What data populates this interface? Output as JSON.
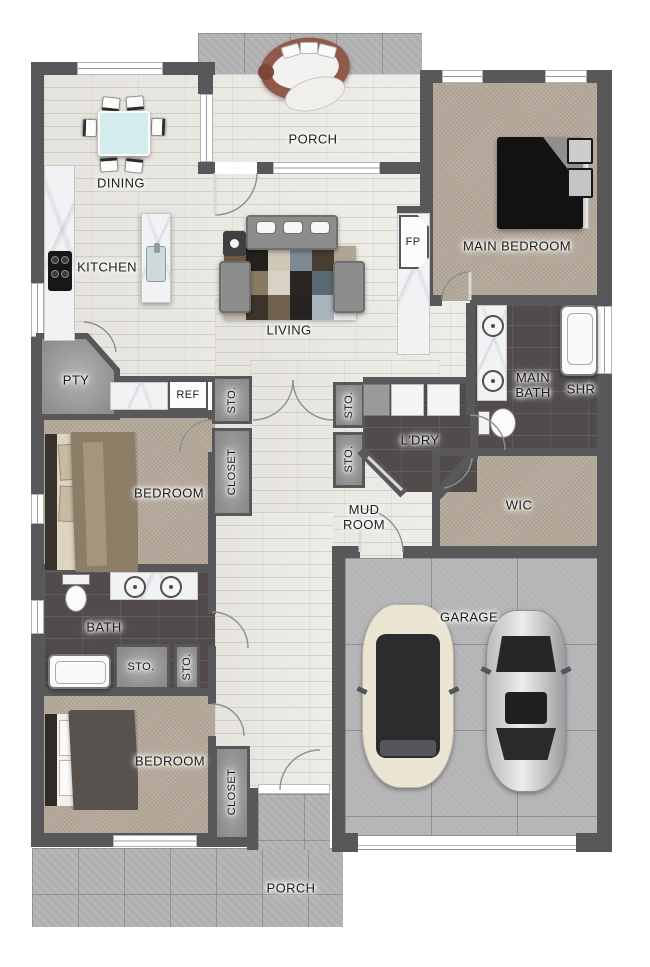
{
  "labels": {
    "porch": "PORCH",
    "dining": "DINING",
    "kitchen": "KITCHEN",
    "living": "LIVING",
    "fireplace": "FP",
    "main_bedroom": "MAIN BEDROOM",
    "pantry": "PTY",
    "fridge": "REF",
    "storage": "STO.",
    "closet": "CLOSET",
    "bedroom": "BEDROOM",
    "main_bath_line1": "MAIN",
    "main_bath_line2": "BATH",
    "shower": "SHR",
    "laundry": "L'DRY",
    "mud_line1": "MUD",
    "mud_line2": "ROOM",
    "wic": "WIC",
    "bath": "BATH",
    "garage": "GARAGE"
  },
  "colors": {
    "wall": "#58585a",
    "wood_floor": "#edece7",
    "carpet": "#b3a799",
    "dark_tile": "#514c4b",
    "porch_tile": "#b0b0b0",
    "garage_floor": "#b4b4b6",
    "bench_wood": "#91594a",
    "car_cream": "#eae4d3",
    "car_silver": "#c9cacc"
  }
}
